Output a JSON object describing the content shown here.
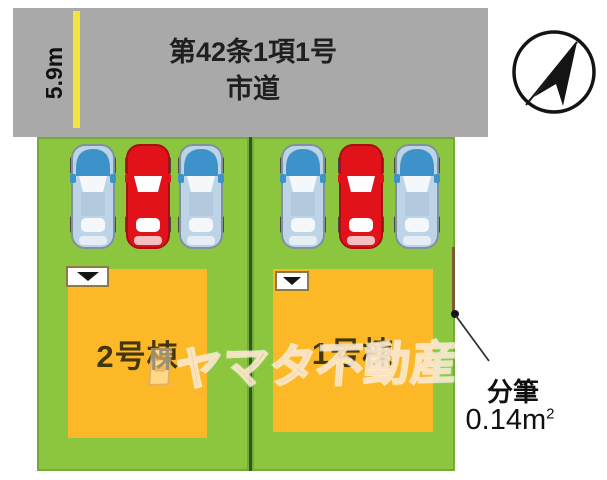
{
  "road": {
    "regulation": "第42条1項1号",
    "road_type": "市道",
    "width_label": "5.9m"
  },
  "plots": {
    "left": {
      "building_label": "2号棟"
    },
    "right": {
      "building_label": "1号棟"
    }
  },
  "subdivision": {
    "label": "分筆",
    "area_value": "0.14m",
    "area_superscript": "2"
  },
  "watermark": {
    "text": "ヤマタ不動産"
  },
  "colors": {
    "road_gray": "#a9a9a9",
    "plot_green": "#8cc63f",
    "building_orange": "#fcb827",
    "road_width_line_yellow": "#f3e43c",
    "car_blue": "#3e92ca",
    "car_red": "#e2121b",
    "subdivision_line_brown": "#7a5a32"
  }
}
